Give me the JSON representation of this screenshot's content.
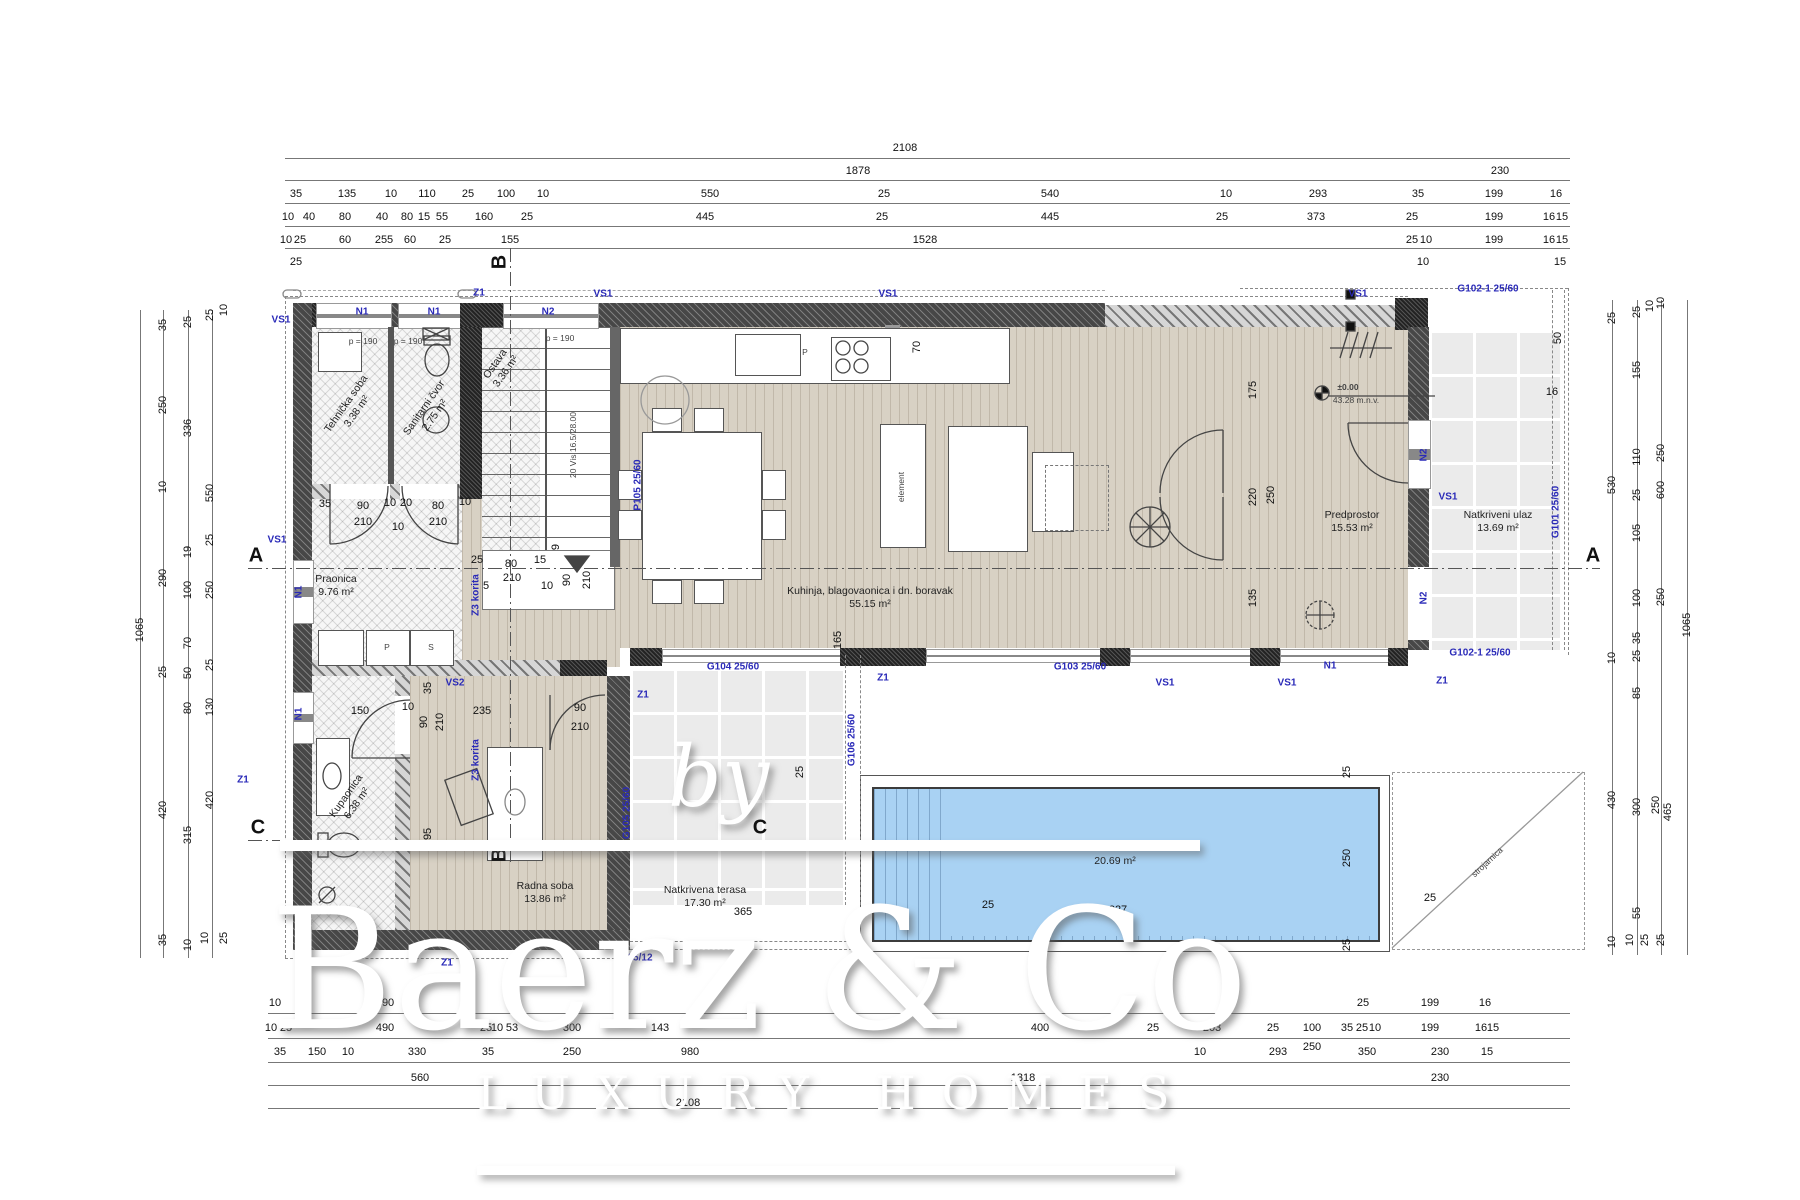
{
  "watermark": {
    "by": "by",
    "brand": "Baerz & Co",
    "tagline": "LUXURY HOMES"
  },
  "colors": {
    "pool": "#a9d2f3",
    "marker_blue": "#2a2ab8",
    "wood": "#d8d1c4",
    "tile": "#ebebeb"
  },
  "elevation": {
    "level": "±0.00",
    "altitude": "43.28 m.n.v."
  },
  "plan": {
    "rooms": [
      {
        "t": "Tehnička soba",
        "ar": "3.38 m²",
        "x": 352,
        "y": 408,
        "r": -55
      },
      {
        "t": "Sanitarni čvor",
        "ar": "2.75 m²",
        "x": 430,
        "y": 412,
        "r": -55
      },
      {
        "t": "Ostava",
        "ar": "3.36 m²",
        "x": 501,
        "y": 368,
        "r": -55
      },
      {
        "t": "Praonica",
        "ar": "9.76 m²",
        "x": 336,
        "y": 586,
        "r": 0
      },
      {
        "t": "Kuhinja, blagovaonica i dn. boravak",
        "ar": "55.15 m²",
        "x": 870,
        "y": 598,
        "r": 0
      },
      {
        "t": "Predprostor",
        "ar": "15.53 m²",
        "x": 1352,
        "y": 522,
        "r": 0
      },
      {
        "t": "Natkriveni ulaz",
        "ar": "13.69 m²",
        "x": 1498,
        "y": 522,
        "r": 0
      },
      {
        "t": "Kupaonica",
        "ar": "6.38 m²",
        "x": 352,
        "y": 800,
        "r": -55
      },
      {
        "t": "Radna soba",
        "ar": "13.86 m²",
        "x": 545,
        "y": 893,
        "r": 0
      },
      {
        "t": "Natkrivena terasa",
        "ar": "17.30 m²",
        "x": 705,
        "y": 897,
        "r": 0
      },
      {
        "t": "Bazen",
        "ar": "20.69 m²",
        "x": 1115,
        "y": 855,
        "r": 0
      }
    ],
    "blue": [
      {
        "t": "N1",
        "x": 362,
        "y": 312
      },
      {
        "t": "N1",
        "x": 434,
        "y": 312
      },
      {
        "t": "N2",
        "x": 548,
        "y": 312
      },
      {
        "t": "VS1",
        "x": 281,
        "y": 320
      },
      {
        "t": "VS1",
        "x": 603,
        "y": 294
      },
      {
        "t": "VS1",
        "x": 888,
        "y": 294
      },
      {
        "t": "VS1",
        "x": 1358,
        "y": 294
      },
      {
        "t": "VS1",
        "x": 277,
        "y": 540
      },
      {
        "t": "VS1",
        "x": 1448,
        "y": 497
      },
      {
        "t": "VS1",
        "x": 1165,
        "y": 683
      },
      {
        "t": "VS1",
        "x": 1287,
        "y": 683
      },
      {
        "t": "Z1",
        "x": 479,
        "y": 293
      },
      {
        "t": "Z1",
        "x": 243,
        "y": 780
      },
      {
        "t": "Z1",
        "x": 447,
        "y": 963
      },
      {
        "t": "Z1",
        "x": 643,
        "y": 695
      },
      {
        "t": "Z1",
        "x": 883,
        "y": 678
      },
      {
        "t": "Z1",
        "x": 1442,
        "y": 681
      },
      {
        "t": "N1",
        "x": 299,
        "y": 592,
        "r": -90
      },
      {
        "t": "N1",
        "x": 299,
        "y": 714,
        "r": -90
      },
      {
        "t": "N1",
        "x": 1330,
        "y": 666
      },
      {
        "t": "N2",
        "x": 1424,
        "y": 455,
        "r": -90
      },
      {
        "t": "N2",
        "x": 1424,
        "y": 598,
        "r": -90
      },
      {
        "t": "VS2",
        "x": 455,
        "y": 683
      },
      {
        "t": "P105 25/60",
        "x": 638,
        "y": 485,
        "r": -90
      },
      {
        "t": "G105 25/60",
        "x": 627,
        "y": 813,
        "r": -90
      },
      {
        "t": "G106 25/60",
        "x": 852,
        "y": 740,
        "r": -90
      },
      {
        "t": "G104 25/60",
        "x": 733,
        "y": 667
      },
      {
        "t": "G103 25/60",
        "x": 1080,
        "y": 667
      },
      {
        "t": "G101 25/60",
        "x": 1556,
        "y": 512,
        "r": -90
      },
      {
        "t": "G102-1 25/60",
        "x": 1488,
        "y": 289
      },
      {
        "t": "G102-1 25/60",
        "x": 1480,
        "y": 653
      },
      {
        "t": "25/12",
        "x": 640,
        "y": 958
      },
      {
        "t": "Z3 korita",
        "x": 476,
        "y": 595,
        "r": -90
      },
      {
        "t": "Z3 korita",
        "x": 476,
        "y": 760,
        "r": -90
      }
    ],
    "tiny": [
      {
        "t": "p = 190",
        "x": 363,
        "y": 341
      },
      {
        "t": "p = 190",
        "x": 408,
        "y": 341
      },
      {
        "t": "p = 190",
        "x": 560,
        "y": 338
      },
      {
        "t": "20 Vis 16.5/28.00",
        "x": 573,
        "y": 445,
        "r": -90
      },
      {
        "t": "P",
        "x": 805,
        "y": 352
      },
      {
        "t": "P",
        "x": 387,
        "y": 647
      },
      {
        "t": "S",
        "x": 431,
        "y": 647
      },
      {
        "t": "element",
        "x": 901,
        "y": 487,
        "r": -90
      },
      {
        "t": "strojarnica",
        "x": 1487,
        "y": 862,
        "r": -43
      }
    ],
    "sections": [
      {
        "t": "A",
        "x": 256,
        "y": 556
      },
      {
        "t": "A",
        "x": 1593,
        "y": 556
      },
      {
        "t": "B",
        "x": 500,
        "y": 262,
        "r": -90
      },
      {
        "t": "B",
        "x": 500,
        "y": 855,
        "r": -90
      },
      {
        "t": "C",
        "x": 258,
        "y": 828
      },
      {
        "t": "C",
        "x": 760,
        "y": 828
      }
    ]
  },
  "dims": {
    "h": [
      {
        "t": "2108",
        "x": 905,
        "y": 148
      },
      {
        "t": "1878",
        "x": 858,
        "y": 171
      },
      {
        "t": "230",
        "x": 1500,
        "y": 171
      },
      {
        "t": "35",
        "x": 296,
        "y": 194
      },
      {
        "t": "135",
        "x": 347,
        "y": 194
      },
      {
        "t": "10",
        "x": 391,
        "y": 194
      },
      {
        "t": "110",
        "x": 427,
        "y": 194
      },
      {
        "t": "25",
        "x": 468,
        "y": 194
      },
      {
        "t": "100",
        "x": 506,
        "y": 194
      },
      {
        "t": "10",
        "x": 543,
        "y": 194
      },
      {
        "t": "550",
        "x": 710,
        "y": 194
      },
      {
        "t": "25",
        "x": 884,
        "y": 194
      },
      {
        "t": "540",
        "x": 1050,
        "y": 194
      },
      {
        "t": "10",
        "x": 1226,
        "y": 194
      },
      {
        "t": "293",
        "x": 1318,
        "y": 194
      },
      {
        "t": "35",
        "x": 1418,
        "y": 194
      },
      {
        "t": "199",
        "x": 1494,
        "y": 194
      },
      {
        "t": "16",
        "x": 1556,
        "y": 194
      },
      {
        "t": "10",
        "x": 288,
        "y": 217
      },
      {
        "t": "40",
        "x": 309,
        "y": 217
      },
      {
        "t": "80",
        "x": 345,
        "y": 217
      },
      {
        "t": "40",
        "x": 382,
        "y": 217
      },
      {
        "t": "80",
        "x": 407,
        "y": 217
      },
      {
        "t": "15",
        "x": 424,
        "y": 217
      },
      {
        "t": "55",
        "x": 442,
        "y": 217
      },
      {
        "t": "160",
        "x": 484,
        "y": 217
      },
      {
        "t": "25",
        "x": 527,
        "y": 217
      },
      {
        "t": "445",
        "x": 705,
        "y": 217
      },
      {
        "t": "25",
        "x": 882,
        "y": 217
      },
      {
        "t": "445",
        "x": 1050,
        "y": 217
      },
      {
        "t": "25",
        "x": 1222,
        "y": 217
      },
      {
        "t": "373",
        "x": 1316,
        "y": 217
      },
      {
        "t": "25",
        "x": 1412,
        "y": 217
      },
      {
        "t": "199",
        "x": 1494,
        "y": 217
      },
      {
        "t": "16",
        "x": 1549,
        "y": 217
      },
      {
        "t": "15",
        "x": 1562,
        "y": 217
      },
      {
        "t": "10",
        "x": 286,
        "y": 240
      },
      {
        "t": "25",
        "x": 300,
        "y": 240
      },
      {
        "t": "60",
        "x": 345,
        "y": 240
      },
      {
        "t": "255",
        "x": 384,
        "y": 240
      },
      {
        "t": "60",
        "x": 410,
        "y": 240
      },
      {
        "t": "25",
        "x": 445,
        "y": 240
      },
      {
        "t": "155",
        "x": 510,
        "y": 240
      },
      {
        "t": "1528",
        "x": 925,
        "y": 240
      },
      {
        "t": "25",
        "x": 1412,
        "y": 240
      },
      {
        "t": "10",
        "x": 1426,
        "y": 240
      },
      {
        "t": "199",
        "x": 1494,
        "y": 240
      },
      {
        "t": "16",
        "x": 1549,
        "y": 240
      },
      {
        "t": "15",
        "x": 1562,
        "y": 240
      },
      {
        "t": "25",
        "x": 296,
        "y": 262
      },
      {
        "t": "10",
        "x": 1423,
        "y": 262
      },
      {
        "t": "15",
        "x": 1560,
        "y": 262
      },
      {
        "t": "10",
        "x": 275,
        "y": 1003
      },
      {
        "t": "490",
        "x": 385,
        "y": 1003
      },
      {
        "t": "25",
        "x": 1363,
        "y": 1003
      },
      {
        "t": "199",
        "x": 1430,
        "y": 1003
      },
      {
        "t": "16",
        "x": 1485,
        "y": 1003
      },
      {
        "t": "10",
        "x": 271,
        "y": 1028
      },
      {
        "t": "25",
        "x": 286,
        "y": 1028
      },
      {
        "t": "490",
        "x": 385,
        "y": 1028
      },
      {
        "t": "25",
        "x": 486,
        "y": 1028
      },
      {
        "t": "10",
        "x": 497,
        "y": 1028
      },
      {
        "t": "53",
        "x": 512,
        "y": 1028
      },
      {
        "t": "300",
        "x": 572,
        "y": 1028
      },
      {
        "t": "143",
        "x": 660,
        "y": 1028
      },
      {
        "t": "400",
        "x": 1040,
        "y": 1028
      },
      {
        "t": "25",
        "x": 1153,
        "y": 1028
      },
      {
        "t": "203",
        "x": 1212,
        "y": 1028
      },
      {
        "t": "25",
        "x": 1273,
        "y": 1028
      },
      {
        "t": "100",
        "x": 1312,
        "y": 1028
      },
      {
        "t": "35",
        "x": 1347,
        "y": 1028
      },
      {
        "t": "25",
        "x": 1362,
        "y": 1028
      },
      {
        "t": "10",
        "x": 1375,
        "y": 1028
      },
      {
        "t": "199",
        "x": 1430,
        "y": 1028
      },
      {
        "t": "16",
        "x": 1481,
        "y": 1028
      },
      {
        "t": "15",
        "x": 1493,
        "y": 1028
      },
      {
        "t": "35",
        "x": 280,
        "y": 1052
      },
      {
        "t": "150",
        "x": 317,
        "y": 1052
      },
      {
        "t": "10",
        "x": 348,
        "y": 1052
      },
      {
        "t": "330",
        "x": 417,
        "y": 1052
      },
      {
        "t": "35",
        "x": 488,
        "y": 1052
      },
      {
        "t": "250",
        "x": 572,
        "y": 1052
      },
      {
        "t": "980",
        "x": 690,
        "y": 1052
      },
      {
        "t": "10",
        "x": 1200,
        "y": 1052
      },
      {
        "t": "293",
        "x": 1278,
        "y": 1052
      },
      {
        "t": "250",
        "x": 1312,
        "y": 1047
      },
      {
        "t": "350",
        "x": 1367,
        "y": 1052
      },
      {
        "t": "230",
        "x": 1440,
        "y": 1052
      },
      {
        "t": "15",
        "x": 1487,
        "y": 1052
      },
      {
        "t": "560",
        "x": 420,
        "y": 1078
      },
      {
        "t": "1318",
        "x": 1023,
        "y": 1078
      },
      {
        "t": "230",
        "x": 1440,
        "y": 1078
      },
      {
        "t": "2108",
        "x": 688,
        "y": 1103
      },
      {
        "t": "150",
        "x": 360,
        "y": 711
      },
      {
        "t": "10",
        "x": 408,
        "y": 707
      },
      {
        "t": "235",
        "x": 482,
        "y": 711
      },
      {
        "t": "90",
        "x": 580,
        "y": 708
      },
      {
        "t": "210",
        "x": 580,
        "y": 727
      },
      {
        "t": "35",
        "x": 325,
        "y": 504
      },
      {
        "t": "90",
        "x": 363,
        "y": 506
      },
      {
        "t": "10",
        "x": 390,
        "y": 503
      },
      {
        "t": "20",
        "x": 406,
        "y": 503
      },
      {
        "t": "80",
        "x": 438,
        "y": 506
      },
      {
        "t": "10",
        "x": 465,
        "y": 502
      },
      {
        "t": "210",
        "x": 363,
        "y": 522
      },
      {
        "t": "10",
        "x": 398,
        "y": 527
      },
      {
        "t": "210",
        "x": 438,
        "y": 522
      },
      {
        "t": "25",
        "x": 477,
        "y": 560
      },
      {
        "t": "80",
        "x": 511,
        "y": 564
      },
      {
        "t": "15",
        "x": 540,
        "y": 560
      },
      {
        "t": "5",
        "x": 486,
        "y": 586
      },
      {
        "t": "210",
        "x": 512,
        "y": 578
      },
      {
        "t": "10",
        "x": 547,
        "y": 586
      },
      {
        "t": "827",
        "x": 1118,
        "y": 910
      },
      {
        "t": "25",
        "x": 1430,
        "y": 898
      },
      {
        "t": "25",
        "x": 988,
        "y": 905
      },
      {
        "t": "365",
        "x": 743,
        "y": 912
      },
      {
        "t": "16",
        "x": 1552,
        "y": 392
      }
    ],
    "v": [
      {
        "t": "1065",
        "x": 140,
        "y": 630
      },
      {
        "t": "35",
        "x": 163,
        "y": 325
      },
      {
        "t": "250",
        "x": 163,
        "y": 405
      },
      {
        "t": "10",
        "x": 163,
        "y": 487
      },
      {
        "t": "290",
        "x": 163,
        "y": 578
      },
      {
        "t": "25",
        "x": 163,
        "y": 672
      },
      {
        "t": "420",
        "x": 163,
        "y": 810
      },
      {
        "t": "35",
        "x": 163,
        "y": 940
      },
      {
        "t": "25",
        "x": 188,
        "y": 322
      },
      {
        "t": "336",
        "x": 188,
        "y": 428
      },
      {
        "t": "19",
        "x": 188,
        "y": 552
      },
      {
        "t": "100",
        "x": 188,
        "y": 590
      },
      {
        "t": "70",
        "x": 188,
        "y": 643
      },
      {
        "t": "50",
        "x": 188,
        "y": 673
      },
      {
        "t": "80",
        "x": 188,
        "y": 708
      },
      {
        "t": "315",
        "x": 188,
        "y": 835
      },
      {
        "t": "10",
        "x": 188,
        "y": 945
      },
      {
        "t": "25",
        "x": 210,
        "y": 315
      },
      {
        "t": "10",
        "x": 224,
        "y": 310
      },
      {
        "t": "550",
        "x": 210,
        "y": 493
      },
      {
        "t": "25",
        "x": 210,
        "y": 540
      },
      {
        "t": "250",
        "x": 210,
        "y": 590
      },
      {
        "t": "25",
        "x": 210,
        "y": 665
      },
      {
        "t": "130",
        "x": 210,
        "y": 707
      },
      {
        "t": "420",
        "x": 210,
        "y": 800
      },
      {
        "t": "10",
        "x": 205,
        "y": 938
      },
      {
        "t": "25",
        "x": 224,
        "y": 938
      },
      {
        "t": "25",
        "x": 1612,
        "y": 318
      },
      {
        "t": "530",
        "x": 1612,
        "y": 485
      },
      {
        "t": "10",
        "x": 1612,
        "y": 658
      },
      {
        "t": "430",
        "x": 1612,
        "y": 800
      },
      {
        "t": "10",
        "x": 1612,
        "y": 942
      },
      {
        "t": "25",
        "x": 1637,
        "y": 312
      },
      {
        "t": "10",
        "x": 1650,
        "y": 306
      },
      {
        "t": "155",
        "x": 1637,
        "y": 370
      },
      {
        "t": "110",
        "x": 1637,
        "y": 457
      },
      {
        "t": "25",
        "x": 1637,
        "y": 495
      },
      {
        "t": "105",
        "x": 1637,
        "y": 533
      },
      {
        "t": "100",
        "x": 1637,
        "y": 598
      },
      {
        "t": "35",
        "x": 1637,
        "y": 638
      },
      {
        "t": "25",
        "x": 1637,
        "y": 656
      },
      {
        "t": "85",
        "x": 1637,
        "y": 693
      },
      {
        "t": "300",
        "x": 1637,
        "y": 807
      },
      {
        "t": "55",
        "x": 1637,
        "y": 913
      },
      {
        "t": "10",
        "x": 1630,
        "y": 940
      },
      {
        "t": "25",
        "x": 1645,
        "y": 940
      },
      {
        "t": "10",
        "x": 1661,
        "y": 303
      },
      {
        "t": "250",
        "x": 1661,
        "y": 453
      },
      {
        "t": "600",
        "x": 1661,
        "y": 490
      },
      {
        "t": "250",
        "x": 1661,
        "y": 597
      },
      {
        "t": "250",
        "x": 1656,
        "y": 805
      },
      {
        "t": "465",
        "x": 1668,
        "y": 812
      },
      {
        "t": "25",
        "x": 1661,
        "y": 940
      },
      {
        "t": "1065",
        "x": 1687,
        "y": 625
      },
      {
        "t": "70",
        "x": 917,
        "y": 347
      },
      {
        "t": "175",
        "x": 1253,
        "y": 390
      },
      {
        "t": "220",
        "x": 1253,
        "y": 497
      },
      {
        "t": "250",
        "x": 1271,
        "y": 495
      },
      {
        "t": "135",
        "x": 1253,
        "y": 598
      },
      {
        "t": "165",
        "x": 838,
        "y": 640
      },
      {
        "t": "25",
        "x": 800,
        "y": 772
      },
      {
        "t": "25",
        "x": 1347,
        "y": 772
      },
      {
        "t": "250",
        "x": 1347,
        "y": 858
      },
      {
        "t": "25",
        "x": 1347,
        "y": 945
      },
      {
        "t": "35",
        "x": 428,
        "y": 688
      },
      {
        "t": "90",
        "x": 424,
        "y": 722
      },
      {
        "t": "210",
        "x": 440,
        "y": 722
      },
      {
        "t": "295",
        "x": 428,
        "y": 837
      },
      {
        "t": "90",
        "x": 567,
        "y": 580
      },
      {
        "t": "210",
        "x": 587,
        "y": 580
      },
      {
        "t": "9",
        "x": 556,
        "y": 547
      },
      {
        "t": "50",
        "x": 1558,
        "y": 338
      }
    ]
  }
}
